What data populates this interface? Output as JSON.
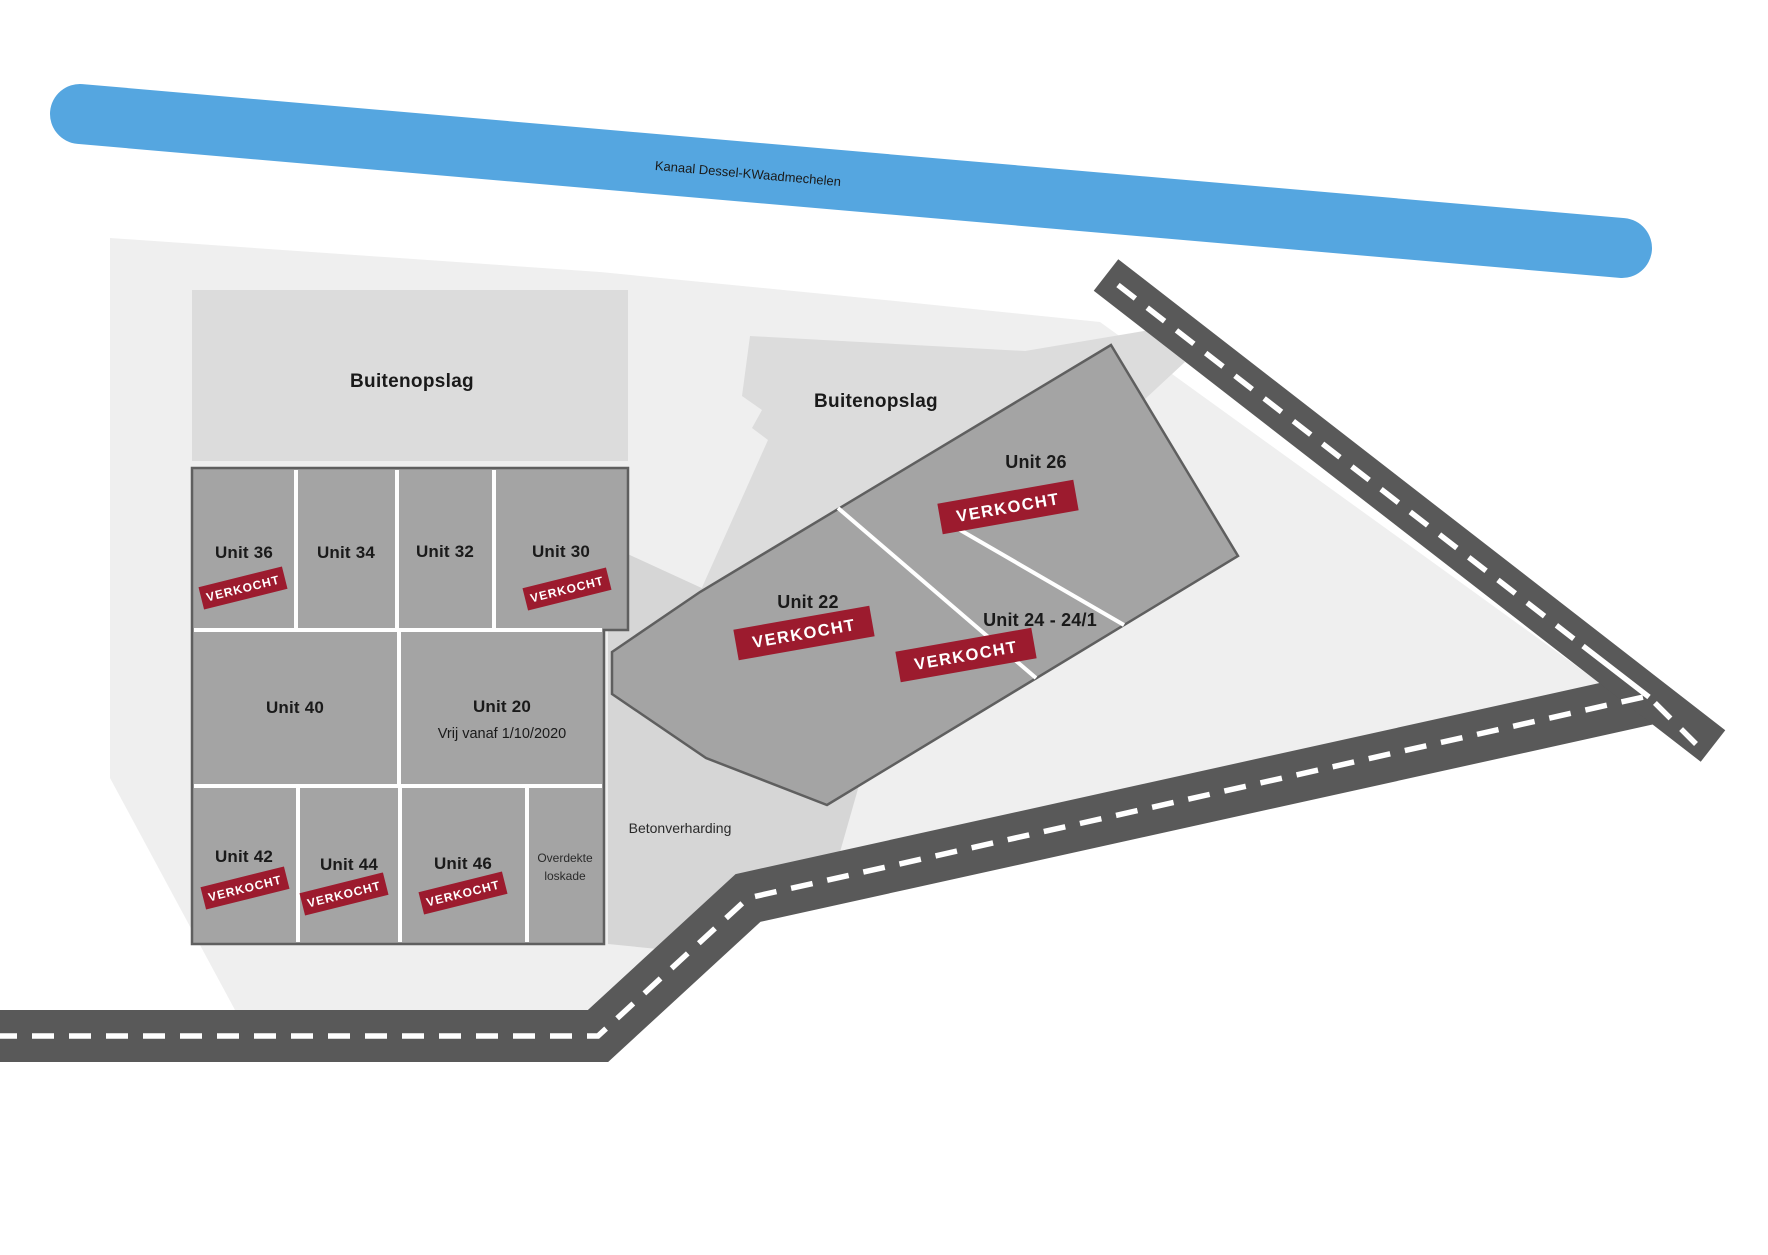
{
  "canal": {
    "label": "Kanaal Dessel-KWaadmechelen"
  },
  "areas": {
    "buitenopslag_left": {
      "label": "Buitenopslag"
    },
    "buitenopslag_right": {
      "label": "Buitenopslag"
    },
    "betonverharding": {
      "label": "Betonverharding"
    }
  },
  "badge_label": "VERKOCHT",
  "colors": {
    "canal": "#55A6E0",
    "road": "#595959",
    "badge": "#9C1B2E",
    "building": "#A4A4A4",
    "site": "#EFEFEF",
    "outdoor_storage": "#DCDCDC",
    "concrete": "#D6D6D6"
  },
  "units": {
    "u36": {
      "label": "Unit 36",
      "status": "VERKOCHT"
    },
    "u34": {
      "label": "Unit 34"
    },
    "u32": {
      "label": "Unit 32"
    },
    "u30": {
      "label": "Unit 30",
      "status": "VERKOCHT"
    },
    "u40": {
      "label": "Unit 40"
    },
    "u20": {
      "label": "Unit 20",
      "note": "Vrij vanaf 1/10/2020"
    },
    "u42": {
      "label": "Unit 42",
      "status": "VERKOCHT"
    },
    "u44": {
      "label": "Unit 44",
      "status": "VERKOCHT"
    },
    "u46": {
      "label": "Unit 46",
      "status": "VERKOCHT"
    },
    "loskade": {
      "line1": "Overdekte",
      "line2": "loskade"
    },
    "u22": {
      "label": "Unit 22",
      "status": "VERKOCHT"
    },
    "u26": {
      "label": "Unit 26",
      "status": "VERKOCHT"
    },
    "u24": {
      "label": "Unit 24 - 24/1",
      "status": "VERKOCHT"
    }
  }
}
